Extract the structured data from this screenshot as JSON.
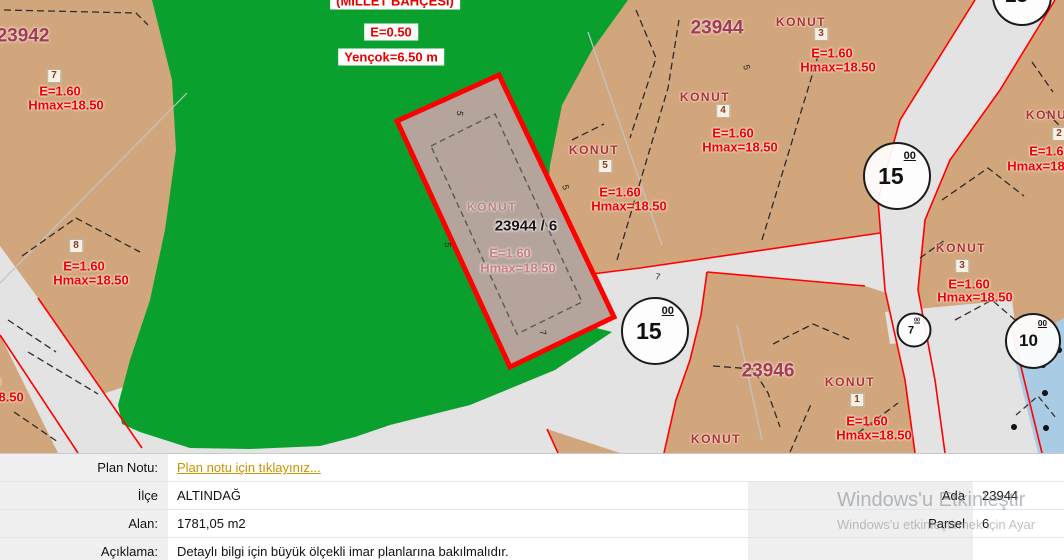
{
  "colors": {
    "park_green": "#0aa02d",
    "parcel_tan": "#d2a67c",
    "road_gray": "#e3e3e3",
    "selected_fill": "#b4a49b",
    "selection_red": "#ff0000",
    "block_number_red": "#a43b52",
    "konut_red": "#b32f2f",
    "zoning_red": "#f20000",
    "water_blue": "#a9cbe4",
    "link_gold": "#c89300",
    "panel_label_bg": "#f0f0f0"
  },
  "map": {
    "park": {
      "name": "(MİLLET BAHÇESİ)",
      "e": "E=0.50",
      "yencok": "Yençok=6.50 m"
    },
    "blocks": [
      {
        "id": "23942"
      },
      {
        "id": "23944"
      },
      {
        "id": "23946"
      }
    ],
    "selected_parcel": {
      "konut": "KONUT",
      "number": "23944 / 6",
      "e": "E=1.60",
      "hmax": "Hmax=18.50"
    },
    "parcels": [
      {
        "badge": "7",
        "e": "E=1.60",
        "hmax": "Hmax=18.50"
      },
      {
        "badge": "8",
        "e": "E=1.60",
        "hmax": "Hmax=18.50"
      },
      {
        "e": "E=1.60",
        "hmax": "Hmax=18.50"
      },
      {
        "konut": "KONUT",
        "badge": "5",
        "e": "E=1.60",
        "hmax": "Hmax=18.50"
      },
      {
        "konut": "KONUT",
        "badge": "4",
        "e": "E=1.60",
        "hmax": "Hmax=18.50"
      },
      {
        "konut": "KONUT",
        "badge": "3",
        "e": "E=1.60",
        "hmax": "Hmax=18.50"
      },
      {
        "konut": "KONUT",
        "badge": "1",
        "e": "E=1.60",
        "hmax": "Hmax=18.50"
      },
      {
        "konut": "KONUT"
      },
      {
        "konut": "KONUT",
        "badge": "3",
        "e": "E=1.60",
        "hmax": "Hmax=18.50"
      },
      {
        "konut": "KONUT",
        "badge": "2",
        "e": "E=1.60",
        "hmax": "Hmax=18.50"
      }
    ],
    "road_circles": [
      {
        "main": "15",
        "sup": "00"
      },
      {
        "main": "15",
        "sup": "00"
      },
      {
        "main": "15",
        "sup": "00"
      },
      {
        "main": "7",
        "sup": "00"
      },
      {
        "main": "10",
        "sup": "00"
      }
    ],
    "ticks": [
      {
        "t": "7"
      },
      {
        "t": "5"
      },
      {
        "t": "5"
      },
      {
        "t": "7"
      },
      {
        "t": "5"
      },
      {
        "t": "5"
      }
    ]
  },
  "panel": {
    "rows": [
      {
        "label": "Plan Notu:",
        "value": "Plan notu için tıklayınız..."
      },
      {
        "label": "İlçe",
        "value": "ALTINDAĞ",
        "right_label": "Ada",
        "right_value": "23944"
      },
      {
        "label": "Alan:",
        "value": "1781,05 m2",
        "right_label": "Parsel",
        "right_value": "6"
      },
      {
        "label": "Açıklama:",
        "value": "Detaylı bilgi için büyük ölçekli imar planlarına bakılmalıdır."
      }
    ]
  },
  "watermark": {
    "line1": "Windows'u Etkinleştir",
    "line2": "Windows'u etkinleştirmek için Ayar"
  }
}
